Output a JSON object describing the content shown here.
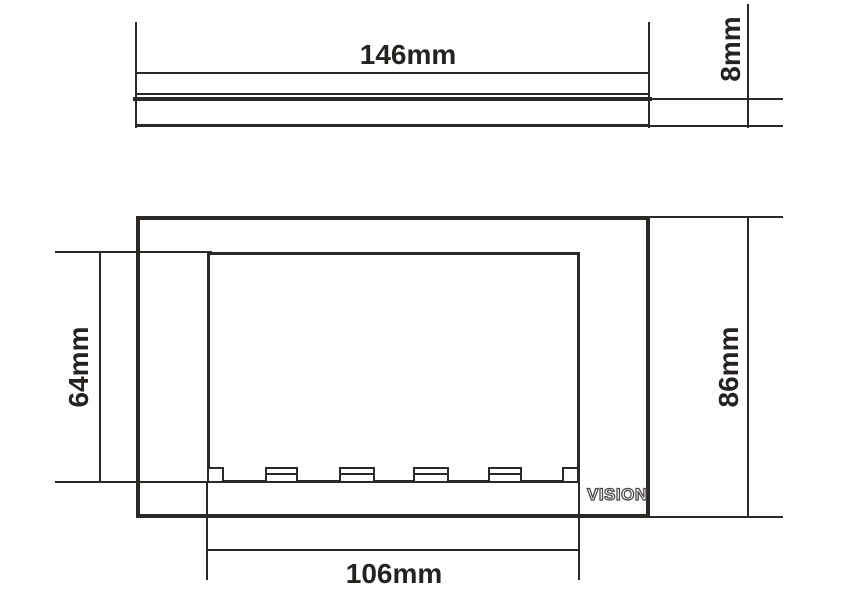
{
  "drawing": {
    "brand_logo": "VISION",
    "profile_view": {
      "width_label": "146mm",
      "depth_label": "8mm"
    },
    "front_view": {
      "aperture_height_label": "64mm",
      "overall_height_label": "86mm",
      "aperture_width_label": "106mm",
      "clip_count": 6
    },
    "colors": {
      "line": "#2c2825",
      "label": "#262220",
      "background": "#ffffff"
    }
  }
}
